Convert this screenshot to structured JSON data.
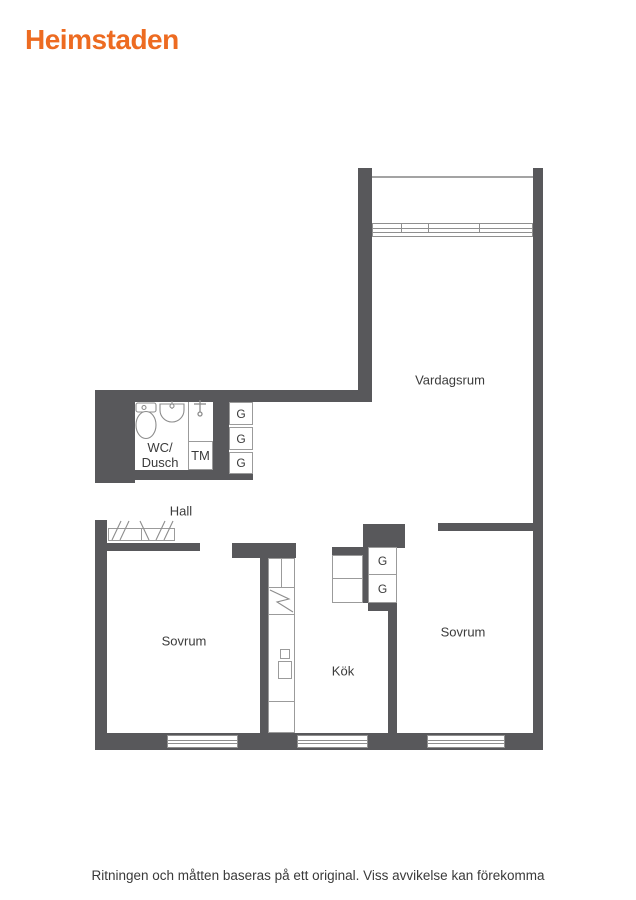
{
  "brand": {
    "logo_text": "Heimstaden",
    "logo_color": "#ed6b21"
  },
  "floor_plan": {
    "rooms": {
      "vardagsrum": {
        "label": "Vardagsrum"
      },
      "hall": {
        "label": "Hall"
      },
      "sovrum_left": {
        "label": "Sovrum"
      },
      "sovrum_right": {
        "label": "Sovrum"
      },
      "kok": {
        "label": "Kök"
      },
      "wc_dusch": {
        "label_line1": "WC/",
        "label_line2": "Dusch"
      }
    },
    "fixtures": {
      "washing_machine": "TM",
      "wardrobe": "G",
      "wardrobe_count": 5
    },
    "colors": {
      "wall": "#58585b",
      "outline": "#9b9b9b",
      "label_text": "#3b3b3b"
    }
  },
  "footer": {
    "disclaimer": "Ritningen och måtten baseras på ett original. Viss avvikelse kan förekomma"
  }
}
